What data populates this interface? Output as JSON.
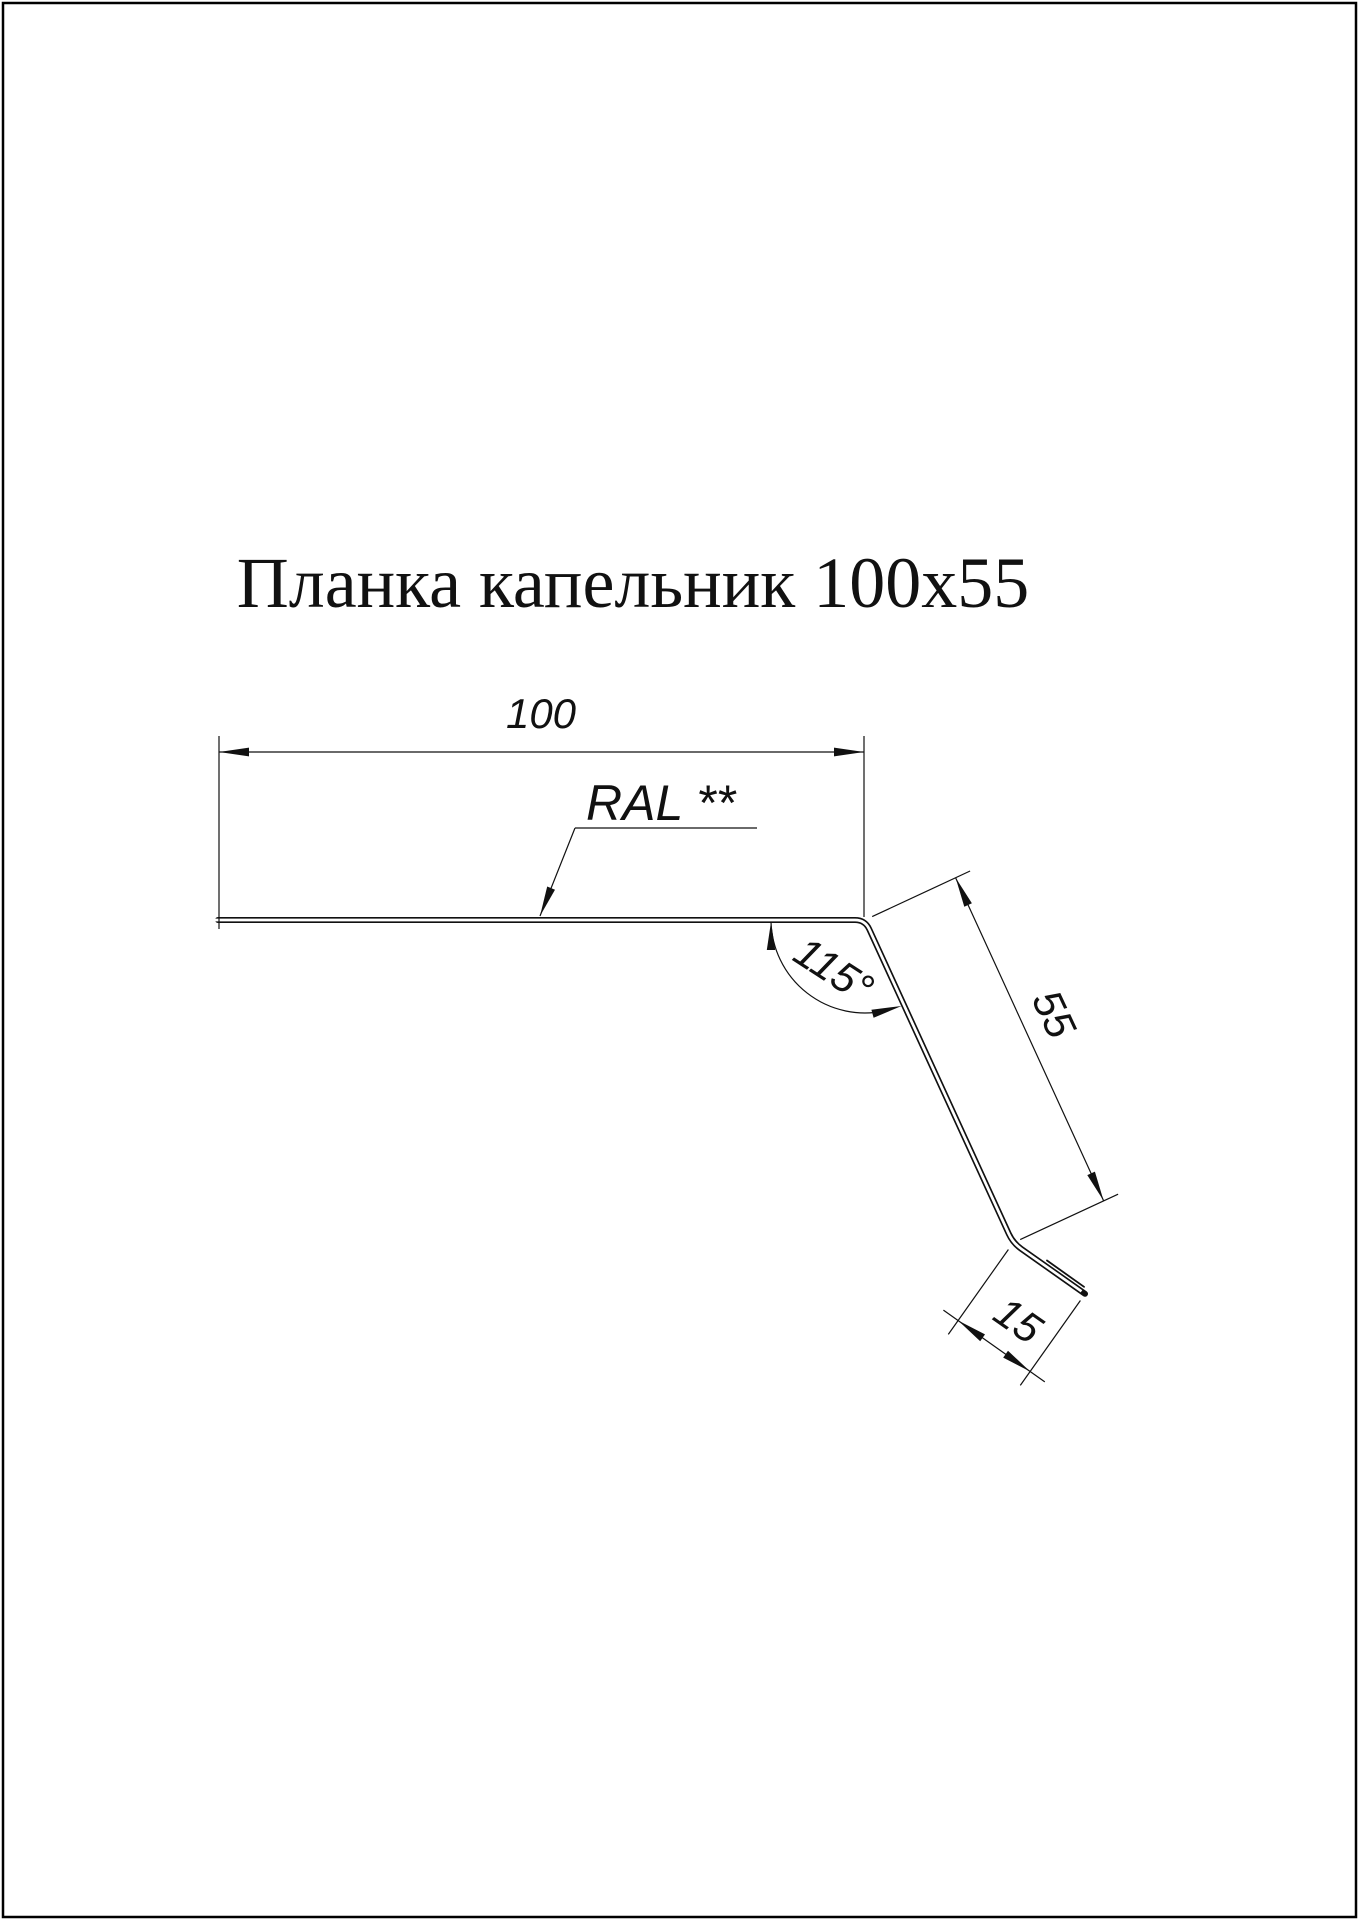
{
  "title": {
    "text": "Планка капельник 100х55"
  },
  "colors": {
    "paper": "#ffffff",
    "ink": "#111111",
    "border": "#000000"
  },
  "drawing": {
    "labels": {
      "width": "100",
      "leg": "55",
      "hem": "15",
      "angle": "115°",
      "ral": "RAL **"
    }
  }
}
